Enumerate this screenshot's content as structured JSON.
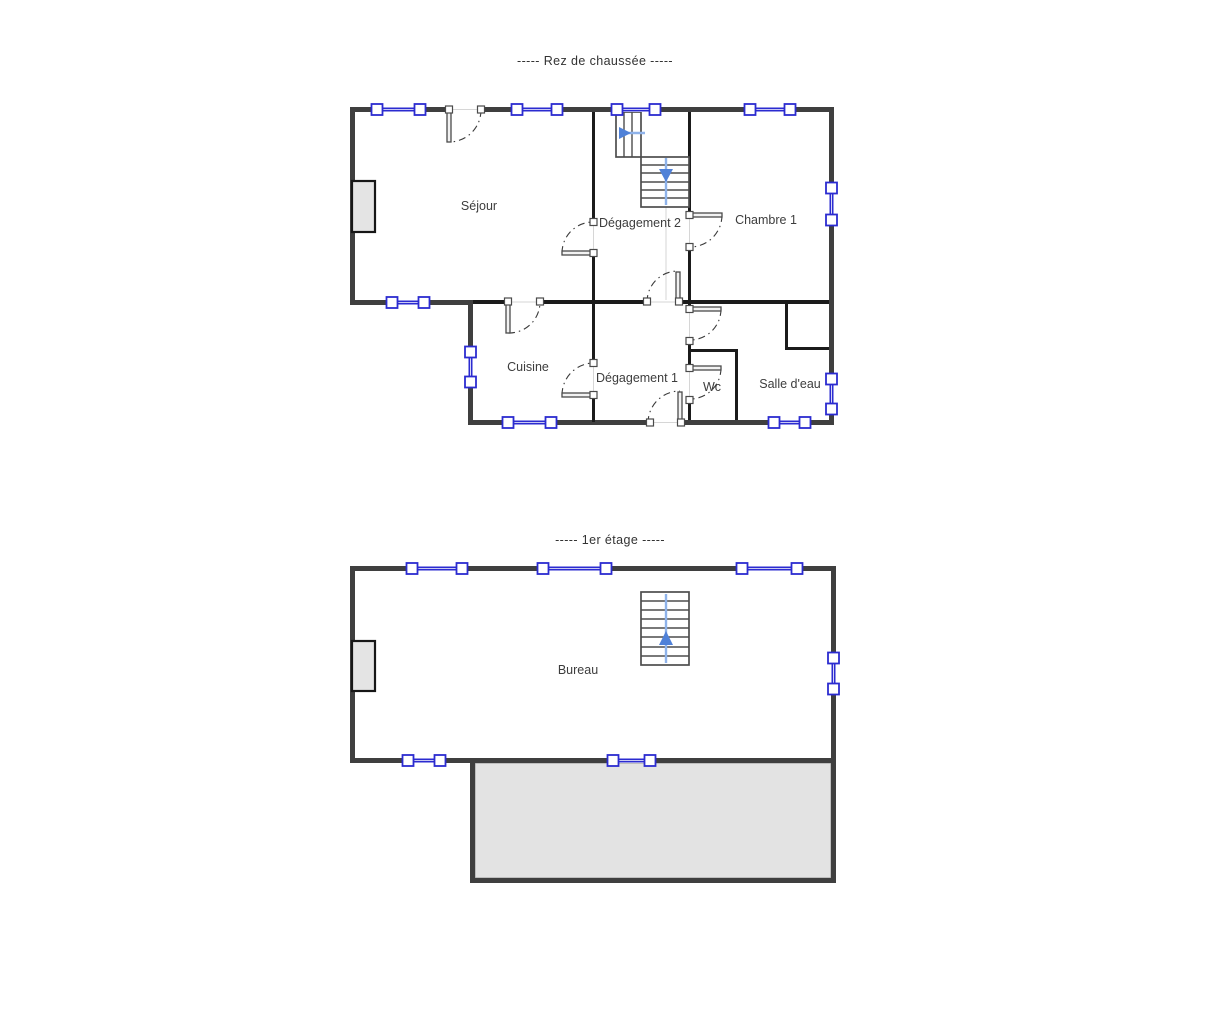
{
  "titles": {
    "ground_floor": "-----  Rez de chaussée  -----",
    "first_floor": "-----  1er étage  -----"
  },
  "rooms": {
    "rdc": [
      "Séjour",
      "Dégagement 2",
      "Chambre 1",
      "Cuisine",
      "Dégagement 1",
      "Wc",
      "Salle d'eau"
    ],
    "etage": [
      "Bureau"
    ]
  },
  "colors": {
    "wall-outer": "#3f3f3f",
    "wall-inner": "#1b1b1b",
    "window-blue": "#2b2bd0",
    "stair-line-blue": "#8fb3ea",
    "stair-arrow-blue": "#4f81d8",
    "terrace-gray": "#e3e3e3",
    "chimney-gray": "#e4e4e4",
    "label-color": "#3d3d3d"
  }
}
